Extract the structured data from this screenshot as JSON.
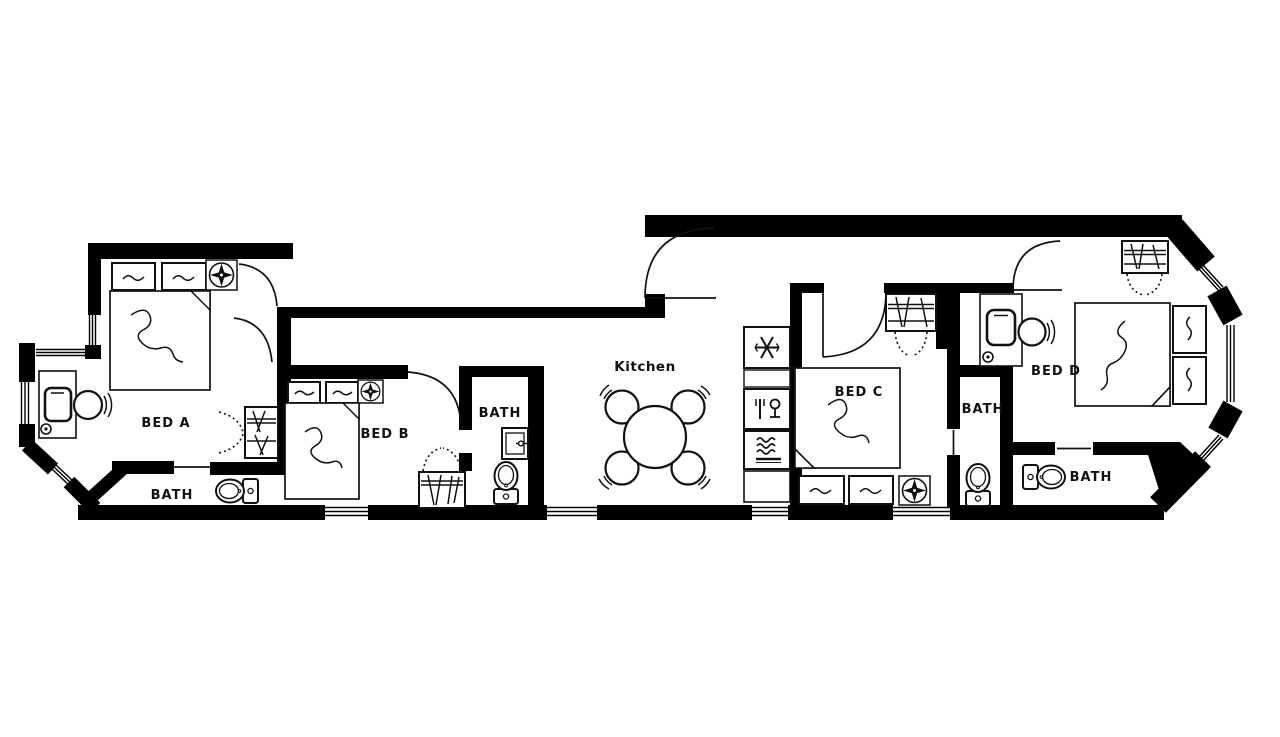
{
  "colors": {
    "background": "#ffffff",
    "walls": "#000000",
    "lines": "#111111",
    "text": "#111111"
  },
  "floor_plan": {
    "rooms": {
      "bed_a": {
        "label": "BED A"
      },
      "bath_a": {
        "label": "BATH"
      },
      "bed_b": {
        "label": "BED B"
      },
      "bath_b": {
        "label": "BATH"
      },
      "kitchen": {
        "label": "Kitchen"
      },
      "bed_c": {
        "label": "BED C"
      },
      "bath_c": {
        "label": "BATH"
      },
      "bed_d": {
        "label": "BED D"
      },
      "bath_d": {
        "label": "BATH"
      }
    },
    "fixtures": {
      "beds": [
        "bed-a",
        "bed-b",
        "bed-c",
        "bed-d"
      ],
      "toilets": 4,
      "sinks": 1,
      "desks_with_chairs": 2,
      "closets_with_hangers": 4,
      "ceiling_fans": 3,
      "dining": {
        "table": "round-table",
        "chairs": 4
      },
      "kitchen_appliances": [
        {
          "name": "refrigerator",
          "icon": "snowflake-icon"
        },
        {
          "name": "dishwasher",
          "icon": "glass-and-fork-icon"
        },
        {
          "name": "stove",
          "icon": "heat-waves-icon"
        },
        {
          "name": "counter",
          "icon": "blank"
        }
      ]
    }
  }
}
